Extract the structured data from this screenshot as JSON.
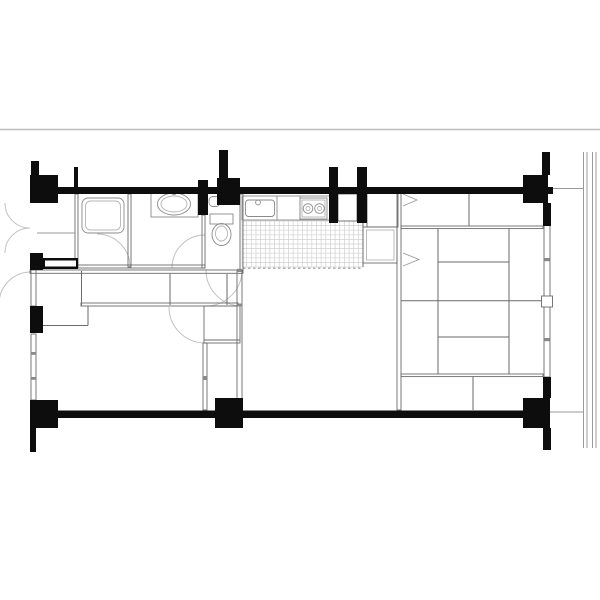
{
  "canvas": {
    "w": 600,
    "h": 600,
    "bg": "#ffffff"
  },
  "colors": {
    "wall": "#0d0d0d",
    "partition": "#6a6a6a",
    "light": "#9a9a9a",
    "tile": "#d0d0d0",
    "arc": "#c2c2c2",
    "fixture": "#8a8a8a",
    "fixture_light": "#b4b4b4",
    "rule": "#bdbdbd",
    "white": "#ffffff"
  },
  "plan": {
    "rule_line": [
      0,
      129.5,
      600,
      129.5
    ],
    "solid_walls": [
      [
        30,
        187,
        523,
        7
      ],
      [
        30,
        410.5,
        520,
        7.5
      ],
      [
        30,
        175,
        28,
        28
      ],
      [
        217,
        178,
        23,
        27
      ],
      [
        523,
        175,
        25,
        28
      ],
      [
        30,
        400,
        28,
        28
      ],
      [
        215,
        398,
        28,
        30
      ],
      [
        523,
        398,
        27,
        30
      ],
      [
        31,
        161,
        8,
        14
      ],
      [
        74,
        167,
        4,
        20
      ],
      [
        219,
        150,
        9,
        28
      ],
      [
        329,
        167,
        9,
        56
      ],
      [
        357,
        167,
        10,
        56
      ],
      [
        542,
        152,
        8,
        23
      ],
      [
        543,
        203,
        8,
        23
      ],
      [
        543,
        377,
        8,
        21
      ],
      [
        543,
        428,
        8,
        22
      ],
      [
        30,
        428,
        6,
        24
      ],
      [
        198,
        180,
        10,
        35
      ],
      [
        30,
        253,
        13,
        17
      ],
      [
        43,
        258,
        35,
        11
      ],
      [
        30,
        306,
        13,
        27
      ]
    ],
    "wall_insets": [
      [
        45,
        260.5,
        31,
        6
      ]
    ],
    "double_walls": [
      [
        31,
        270,
        5,
        36
      ],
      [
        31,
        334,
        5,
        66
      ],
      [
        544,
        225,
        6,
        152
      ],
      [
        75,
        194,
        3,
        73
      ],
      [
        128,
        194,
        3,
        73
      ],
      [
        78,
        265,
        127,
        3
      ],
      [
        30,
        270,
        213,
        3.3
      ],
      [
        202,
        215,
        3,
        53
      ],
      [
        240,
        194,
        3,
        77
      ],
      [
        81,
        303,
        157,
        3
      ],
      [
        204,
        306,
        36,
        37
      ],
      [
        203,
        343,
        4,
        67
      ],
      [
        237,
        270,
        5,
        132
      ],
      [
        338,
        194,
        19,
        27
      ],
      [
        367,
        192,
        31,
        35
      ],
      [
        363,
        227,
        34,
        36
      ],
      [
        397,
        192,
        4,
        218
      ],
      [
        401,
        226,
        142,
        2.6
      ],
      [
        401,
        374,
        142,
        2.6
      ]
    ],
    "partition_lines": [
      [
        81.5,
        271,
        81.5,
        306
      ],
      [
        170,
        274,
        170,
        305
      ],
      [
        227,
        274,
        227,
        305
      ],
      [
        37,
        325.5,
        88,
        325.5
      ],
      [
        88,
        306,
        88,
        325.5
      ],
      [
        204,
        340,
        240,
        340
      ],
      [
        363,
        220,
        363,
        267
      ],
      [
        469,
        194,
        469,
        226
      ],
      [
        473,
        377,
        473,
        410
      ],
      [
        438,
        229,
        438,
        374
      ],
      [
        509,
        229,
        509,
        374
      ],
      [
        401,
        300.7,
        543,
        300.7
      ],
      [
        438,
        262,
        509,
        262
      ],
      [
        438,
        337,
        509,
        337
      ]
    ],
    "light_lines": [
      [
        37,
        233,
        75,
        233
      ],
      [
        277,
        196,
        277,
        220
      ],
      [
        300,
        196,
        300,
        220
      ],
      [
        583.5,
        152,
        583.5,
        448
      ],
      [
        587,
        152,
        587,
        448
      ],
      [
        592.5,
        152,
        592.5,
        448
      ],
      [
        596,
        152,
        596,
        448
      ],
      [
        551,
        188.5,
        584,
        188.5
      ],
      [
        550,
        412,
        584,
        412
      ]
    ],
    "ticks": [
      [
        544,
        258,
        5.5,
        3.2
      ],
      [
        544,
        338,
        5.5,
        3.2
      ],
      [
        31,
        352,
        5,
        2.8
      ],
      [
        31,
        377,
        5,
        2.8
      ],
      [
        203,
        376,
        4,
        4
      ],
      [
        237,
        268.8,
        5,
        3.2
      ],
      [
        237,
        303.5,
        5,
        3
      ]
    ],
    "tile_grid": {
      "x": 242,
      "y": 221,
      "w": 121,
      "h": 46,
      "cols": 26,
      "rows": 10
    },
    "dashed_lines": [
      [
        243,
        268.2,
        363,
        268.2
      ]
    ],
    "door_arcs": [
      [
        30,
        203,
        25,
        90,
        180
      ],
      [
        30,
        253,
        25,
        180,
        270
      ],
      [
        31,
        304,
        32,
        180,
        270
      ],
      [
        97,
        267,
        33,
        270,
        360
      ],
      [
        205,
        268,
        33,
        180,
        270
      ],
      [
        242,
        270,
        36,
        90,
        180
      ],
      [
        206,
        270,
        36,
        0,
        90
      ],
      [
        205,
        307,
        36,
        90,
        180
      ]
    ],
    "chevrons": [
      "403,194 417,200 403,206",
      "403,253 419,259.5 403,266"
    ],
    "fixtures": [
      {
        "n": "bathtub-outer",
        "t": "rect",
        "x": 82,
        "y": 198,
        "w": 42,
        "h": 35,
        "rx": 6,
        "s": "fixture"
      },
      {
        "n": "bathtub-inner",
        "t": "rect",
        "x": 85.5,
        "y": 201,
        "w": 35,
        "h": 29,
        "rx": 5,
        "s": "fixture_light"
      },
      {
        "n": "vanity-counter",
        "t": "rect",
        "x": 151,
        "y": 189,
        "w": 47,
        "h": 28,
        "s": "fixture"
      },
      {
        "n": "vanity-basin",
        "t": "ellipse",
        "cx": 174,
        "cy": 204,
        "rx": 16.5,
        "ry": 11,
        "s": "fixture"
      },
      {
        "n": "vanity-basin-inner",
        "t": "ellipse",
        "cx": 174,
        "cy": 204,
        "rx": 13,
        "ry": 8,
        "s": "fixture_light"
      },
      {
        "n": "vanity-faucet",
        "t": "circle",
        "cx": 174,
        "cy": 192.5,
        "r": 2.2,
        "s": "fixture"
      },
      {
        "n": "toilet-hand-basin",
        "t": "rect",
        "x": 209,
        "y": 196.5,
        "w": 11,
        "h": 10,
        "rx": 4,
        "s": "fixture"
      },
      {
        "n": "toilet-tank",
        "t": "rect",
        "x": 210,
        "y": 214,
        "w": 23,
        "h": 10,
        "s": "fixture"
      },
      {
        "n": "toilet-bowl",
        "t": "ellipse",
        "cx": 221.5,
        "cy": 234.5,
        "rx": 9.5,
        "ry": 11,
        "s": "fixture"
      },
      {
        "n": "toilet-bowl-inner",
        "t": "ellipse",
        "cx": 221.5,
        "cy": 233.5,
        "rx": 6,
        "ry": 7.5,
        "s": "fixture_light"
      },
      {
        "n": "kitchen-counter",
        "t": "rect",
        "x": 242,
        "y": 196,
        "w": 88,
        "h": 24,
        "s": "fixture"
      },
      {
        "n": "kitchen-sink",
        "t": "rect",
        "x": 245.5,
        "y": 200,
        "w": 29,
        "h": 16.5,
        "rx": 3,
        "s": "fixture"
      },
      {
        "n": "kitchen-faucet",
        "t": "circle",
        "cx": 258,
        "cy": 202.5,
        "r": 2.4,
        "s": "fixture"
      },
      {
        "n": "stove",
        "t": "rect",
        "x": 300,
        "y": 198,
        "w": 27,
        "h": 21,
        "s": "fixture"
      },
      {
        "n": "stove-inner",
        "t": "rect",
        "x": 302,
        "y": 200,
        "w": 23,
        "h": 17,
        "s": "fixture_light"
      },
      {
        "n": "burner-left",
        "t": "circle",
        "cx": 308,
        "cy": 208.5,
        "r": 4.8,
        "s": "fixture"
      },
      {
        "n": "burner-left-inner",
        "t": "circle",
        "cx": 308,
        "cy": 208.5,
        "r": 2,
        "s": "fixture_light"
      },
      {
        "n": "burner-right",
        "t": "circle",
        "cx": 319.5,
        "cy": 208.5,
        "r": 4.8,
        "s": "fixture"
      },
      {
        "n": "burner-right-inner",
        "t": "circle",
        "cx": 319.5,
        "cy": 208.5,
        "r": 2,
        "s": "fixture_light"
      },
      {
        "n": "refrigerator-inner",
        "t": "rect",
        "x": 366.5,
        "y": 230,
        "w": 27.5,
        "h": 30,
        "s": "fixture_light"
      },
      {
        "n": "window-handle",
        "t": "rect",
        "x": 541.5,
        "y": 296,
        "w": 11,
        "h": 11,
        "s": "partition",
        "f": "white"
      }
    ]
  }
}
